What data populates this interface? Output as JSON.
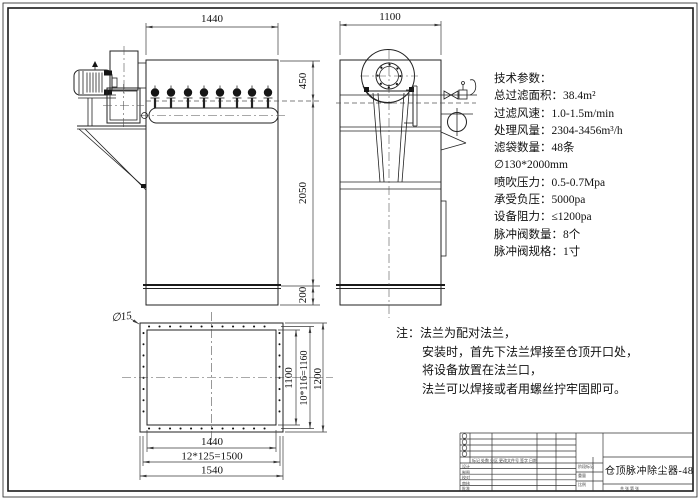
{
  "drawing": {
    "tech_params": {
      "heading": "技术参数：",
      "lines": [
        "总过滤面积：38.4m²",
        "过滤风速：1.0-1.5m/min",
        "处理风量：2304-3456m³/h",
        "滤袋数量：48条",
        "∅130*2000mm",
        "喷吹压力：0.5-0.7Mpa",
        "承受负压：5000pa",
        "设备阻力：≤1200pa",
        "脉冲阀数量：8个",
        "脉冲阀规格：1寸"
      ]
    },
    "notes": {
      "prefix": "注：",
      "lines": [
        "法兰为配对法兰，",
        "安装时，首先下法兰焊接至仓顶开口处，",
        "将设备放置在法兰口，",
        "法兰可以焊接或者用螺丝拧牢固即可。"
      ]
    },
    "dims": {
      "front_width": "1440",
      "side_width": "1100",
      "top_section": "450",
      "body_height": "2050",
      "skirt": "200",
      "plan_inner_w": "1440",
      "plan_bolt_w": "12*125=1500",
      "plan_outer_w": "1540",
      "plan_inner_h": "1100",
      "plan_bolt_h": "10*116=1160",
      "plan_outer_h": "1200",
      "hole": "∅15"
    },
    "title_block": {
      "title": "仓顶脉冲除尘器-48",
      "header_row": "标记 处数 分区 更改文件号 签字 日期",
      "rows": [
        "设计",
        "制图",
        "校对",
        "审核",
        "批准"
      ],
      "middle": [
        "阶段标记",
        "重量",
        "比例"
      ],
      "sheet": "共 张 第 张"
    }
  },
  "colors": {
    "line": "#222222",
    "dim": "#3a3a3a",
    "background": "#ffffff"
  }
}
